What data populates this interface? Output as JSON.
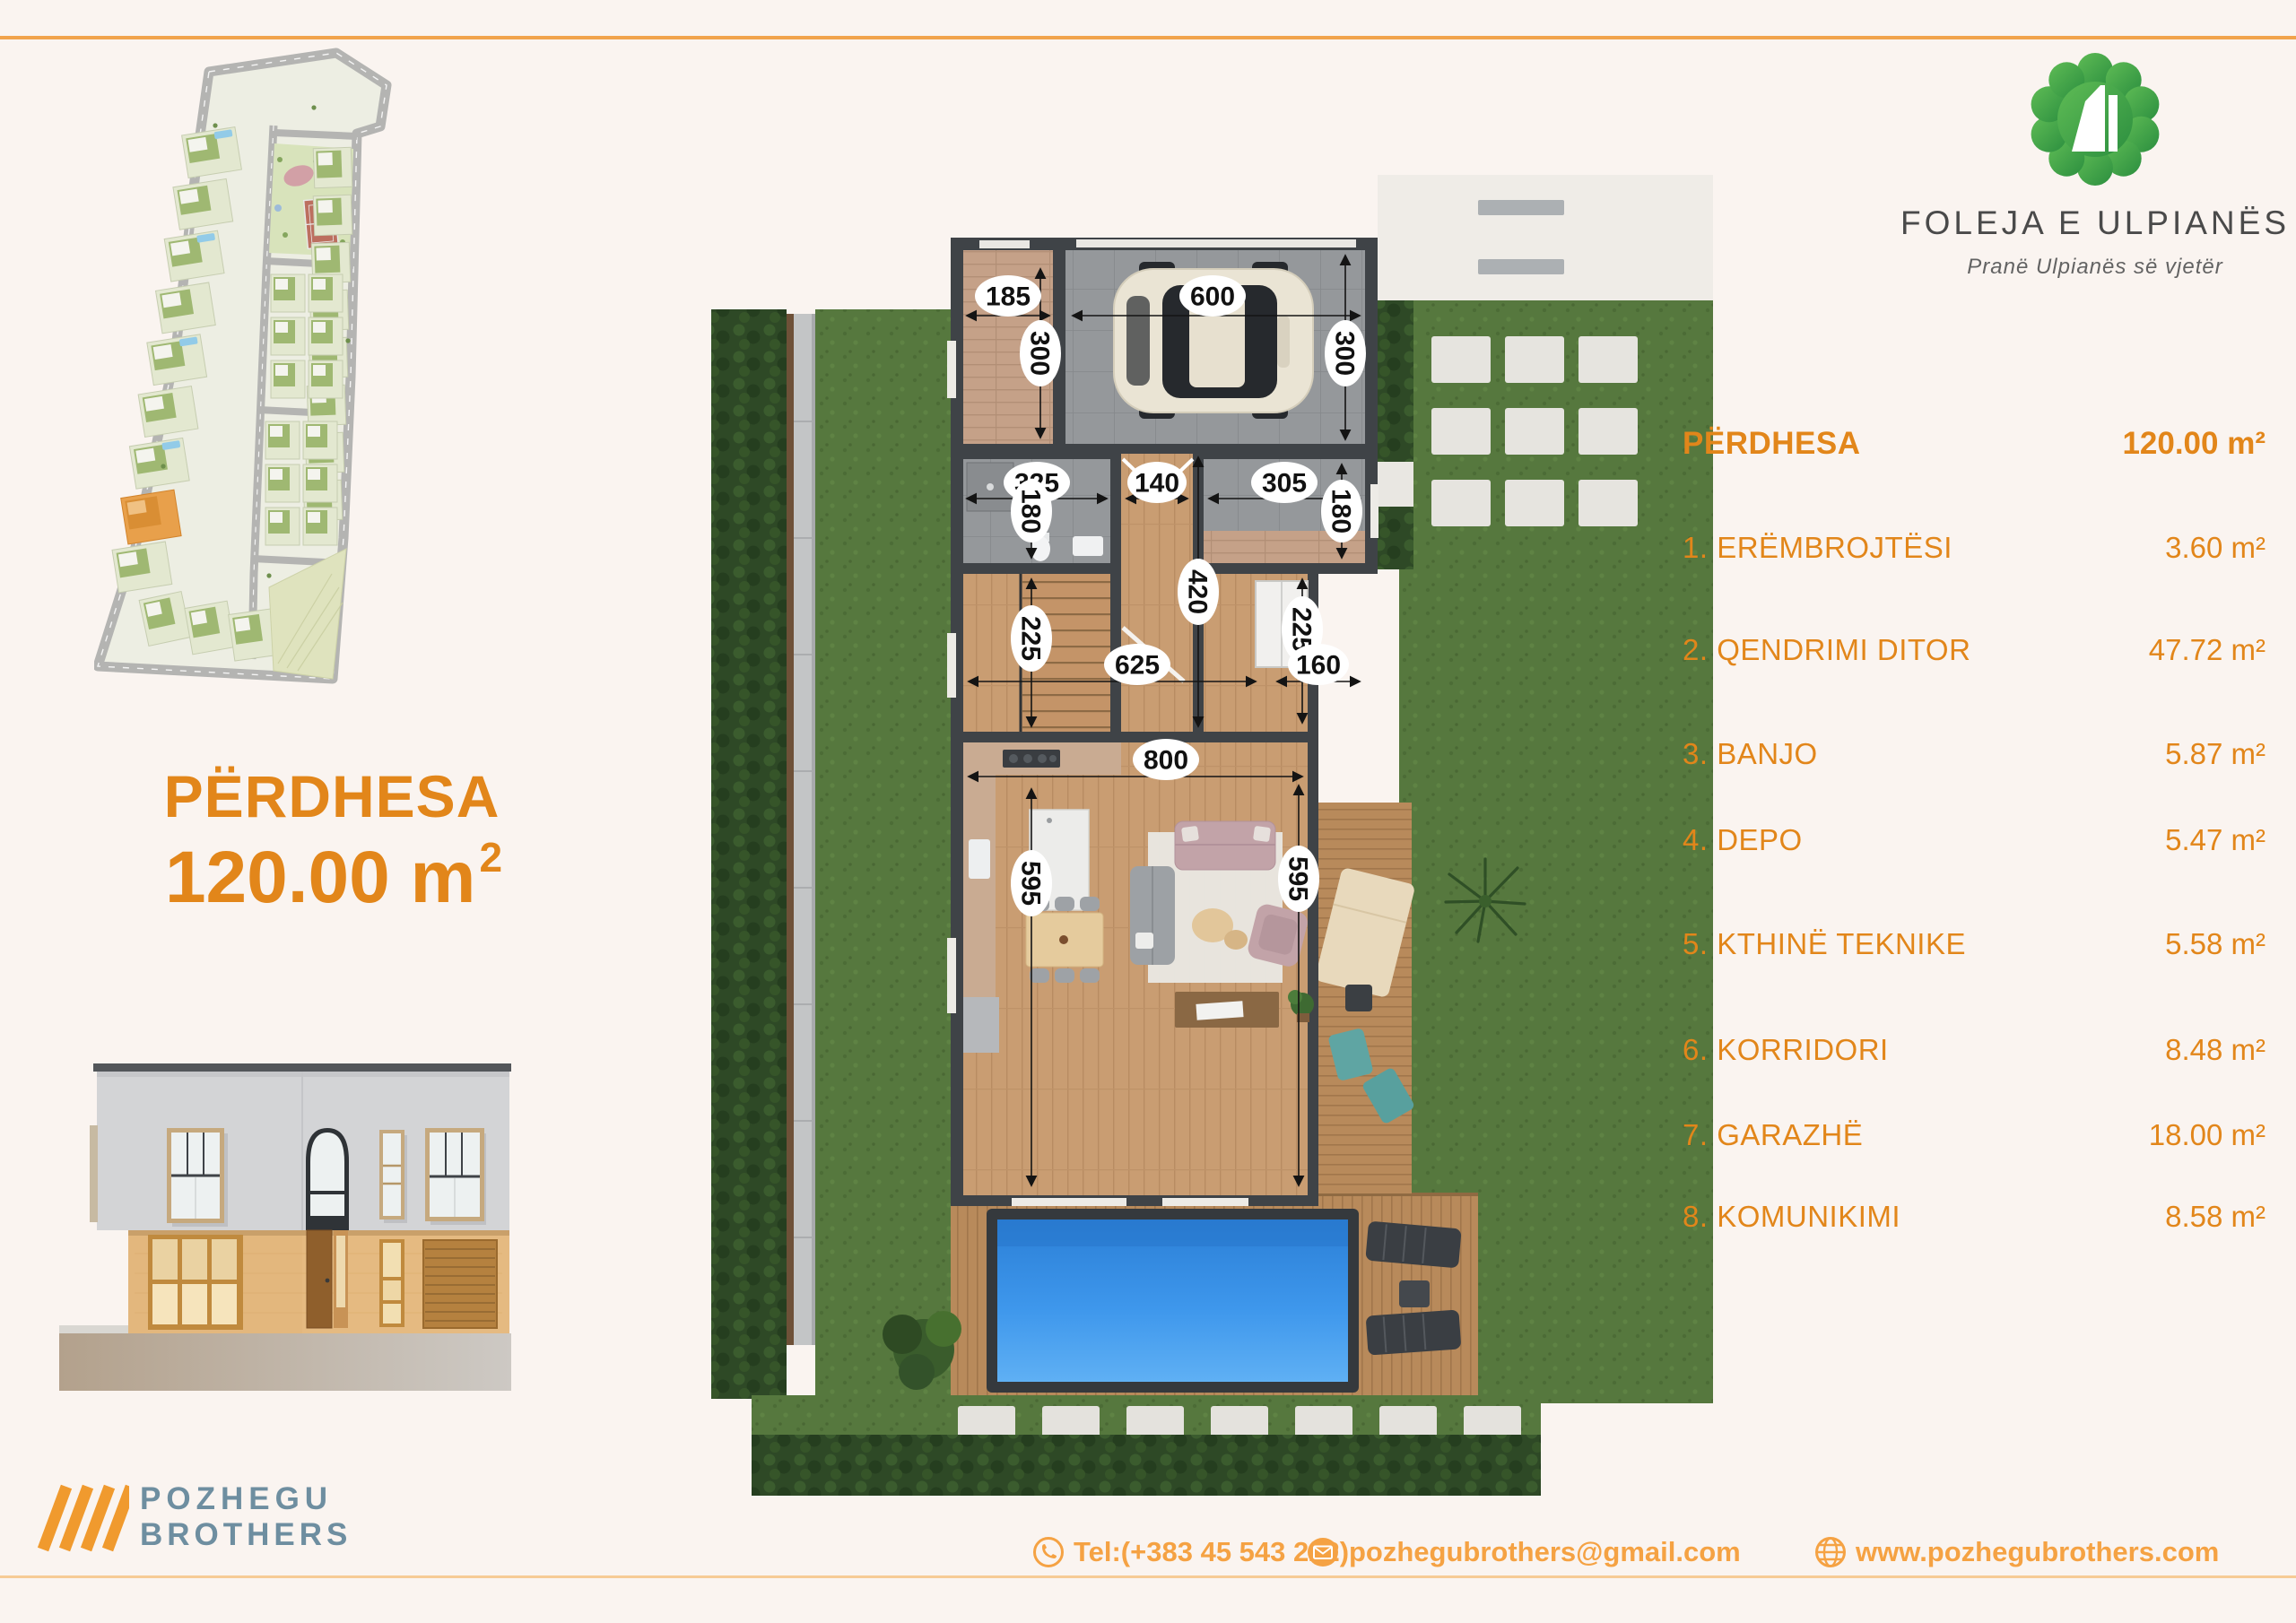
{
  "page": {
    "background": "#FAF4F0",
    "top_line_color": "#F1A34C",
    "footer_line_color": "#F6CB95"
  },
  "brand": {
    "name": "FOLEJA E ULPIANËS",
    "tagline": "Pranë Ulpianës së vjetër",
    "logo_number": "4",
    "logo_green_light": "#5FBC55",
    "logo_green_dark": "#2B8E3F"
  },
  "floor_title": {
    "name": "PËRDHESA",
    "area_value": "120.00 m",
    "area_sup": "2"
  },
  "area_table": {
    "header_label": "PËRDHESA",
    "header_value": "120.00 m²",
    "rows": [
      {
        "label": "1. ERËMBROJTËSI",
        "value": "3.60 m²"
      },
      {
        "label": "2. QENDRIMI DITOR",
        "value": "47.72 m²"
      },
      {
        "label": "3. BANJO",
        "value": "5.87 m²"
      },
      {
        "label": "4. DEPO",
        "value": "5.47 m²"
      },
      {
        "label": "5. KTHINË TEKNIKE",
        "value": "5.58 m²"
      },
      {
        "label": "6. KORRIDORI",
        "value": "8.48 m²"
      },
      {
        "label": "7. GARAZHË",
        "value": "18.00 m²"
      },
      {
        "label": "8. KOMUNIKIMI",
        "value": "8.58 m²"
      }
    ],
    "accent_color": "#E2861A"
  },
  "floorplan": {
    "dims": {
      "w185": "185",
      "w600": "600",
      "h300l": "300",
      "h300r": "300",
      "w325": "325",
      "w140": "140",
      "w305": "305",
      "h180l": "180",
      "h180r": "180",
      "h420": "420",
      "h225l": "225",
      "h225r": "225",
      "w625": "625",
      "w160": "160",
      "w800": "800",
      "h595l": "595",
      "h595r": "595"
    }
  },
  "footer": {
    "company_top": "POZHEGU",
    "company_bottom": "BROTHERS",
    "phone": "Tel:(+383 45 543 222)",
    "email": "pozhegubrothers@gmail.com",
    "website": "www.pozhegubrothers.com"
  }
}
